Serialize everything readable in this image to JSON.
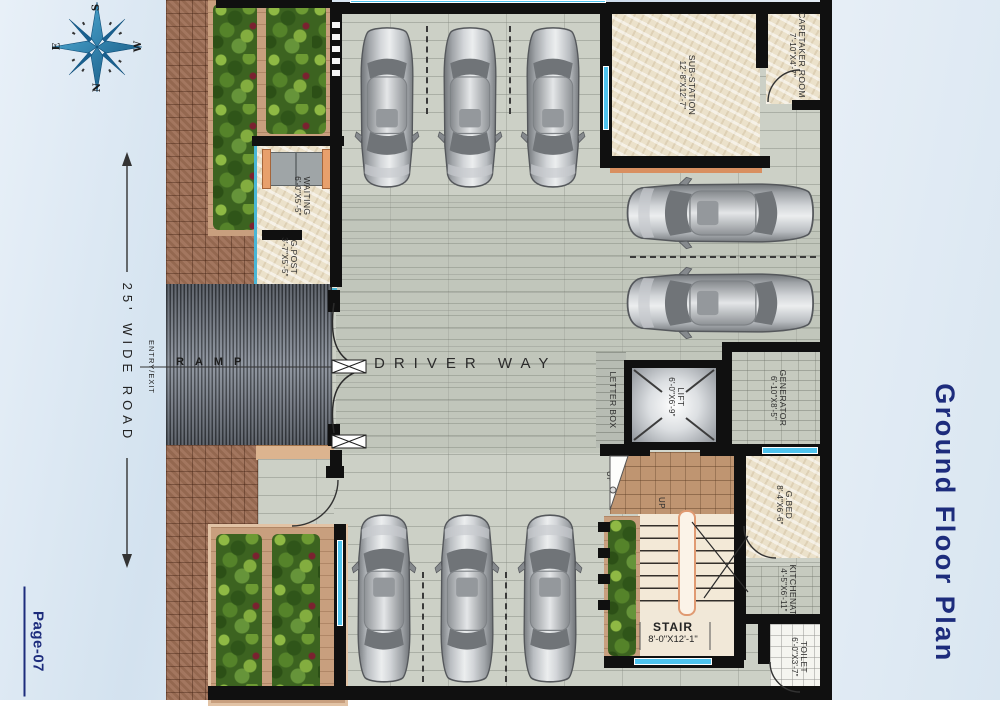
{
  "page": {
    "title": "Ground Floor Plan",
    "number": "Page-07"
  },
  "compass": {
    "n": "N",
    "s": "S",
    "e": "E",
    "w": "W"
  },
  "road": {
    "label": "25' WIDE ROAD",
    "entry_exit": "ENTRY/EXIT",
    "ramp": "RAMP",
    "driver_way": "DRIVER WAY"
  },
  "rooms": {
    "waiting": {
      "name": "WAITING",
      "dims": "6'-0\"X5'-5\""
    },
    "g_post": {
      "name": "G.POST",
      "dims": "3'-7\"X5'-5\""
    },
    "sub_station": {
      "name": "SUB-STATION",
      "dims": "12'-8\"X12'-7\""
    },
    "caretaker": {
      "name": "CARETAKER ROOM",
      "dims": "7'-10\"X4'-7\""
    },
    "letter_box": {
      "name": "LETTER BOX"
    },
    "lift": {
      "name": "LIFT",
      "dims": "6'-0\"X6'-9\""
    },
    "generator": {
      "name": "GENERATOR",
      "dims": "6'-10\"X8'-5\""
    },
    "g_bed": {
      "name": "G.BED",
      "dims": "8'-4\"X6'-6\""
    },
    "kitchenette": {
      "name": "KITCHENAT",
      "dims": "4'-5\"X6'-11\""
    },
    "stair": {
      "name": "STAIR",
      "dims": "8'-0\"X12'-1\"",
      "up": "UP"
    },
    "toilet": {
      "name": "TOILET",
      "dims": "6'-0\"X3'-7\""
    }
  },
  "parking": {
    "car_count": 8
  },
  "colors": {
    "wall": "#101010",
    "window_cyan": "#4ec3ee",
    "title_blue": "#1d2c7c",
    "marble": "#ebe1ca",
    "brick": "#9d6e55",
    "ramp_gray": "#5a6069",
    "floor_tile": "#ccd0c6",
    "garden_green": "#4a7524",
    "sill_orange": "#d98f60"
  }
}
